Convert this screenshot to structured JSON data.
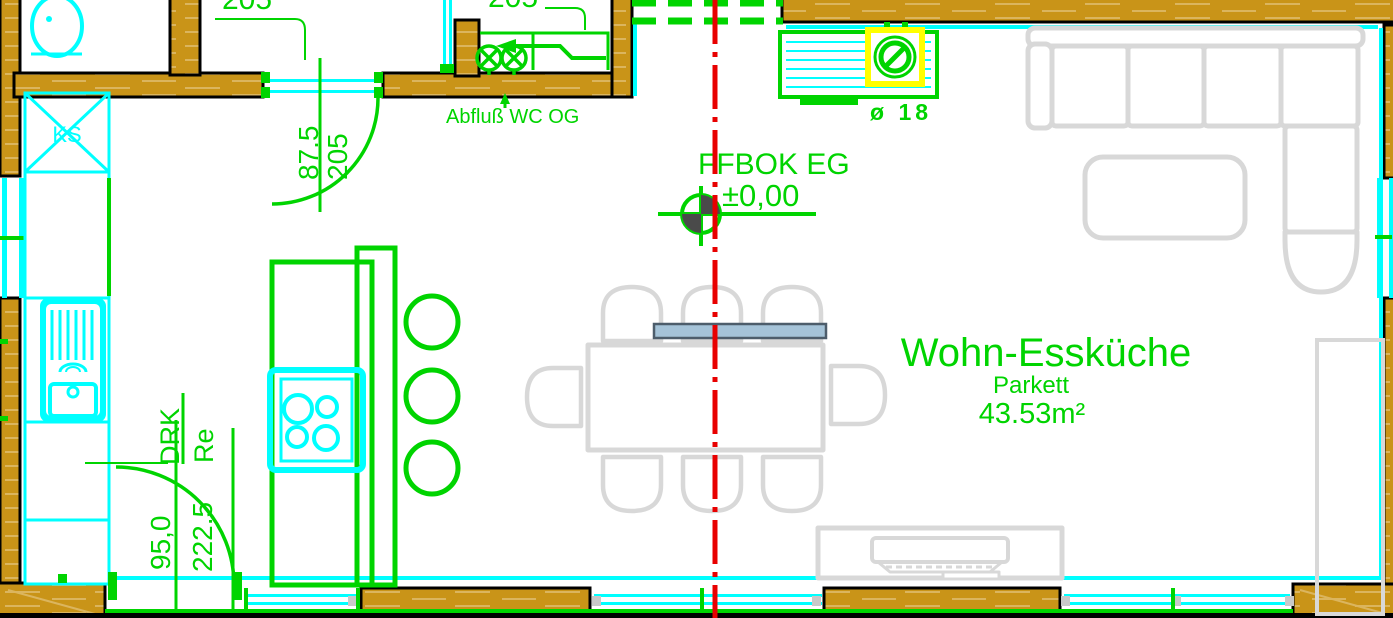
{
  "canvas": {
    "width": 1393,
    "height": 618,
    "type": "cad-floorplan-view"
  },
  "room": {
    "name": "Wohn-Essküche",
    "flooring": "Parkett",
    "area": "43.53m²"
  },
  "level_marker": {
    "label": "FFBOK EG",
    "value": "±0,00"
  },
  "annotations": {
    "drain_note": "Abfluß WC OG",
    "radiator_diameter": "ø 18",
    "shaft_label": "KS",
    "drk_label": "DRK",
    "re_label": "Re"
  },
  "dimensions": {
    "upper_door": {
      "width": "87.5",
      "height": "205"
    },
    "terrace_door": {
      "width": "95,0",
      "height": "222.5"
    },
    "clipped_upper_left": "205",
    "clipped_upper_right": "205"
  },
  "colors": {
    "wall": "#C99418",
    "wall_grain": "#DBB55E",
    "outline": "#000000",
    "fixture_cyan": "#00FFFF",
    "annotation_green": "#00D400",
    "section_red": "#E80000",
    "furniture_gray": "#D8D8D8",
    "highlight_yellow": "#FFFF00",
    "bench_blue": "#A5C3D8"
  }
}
